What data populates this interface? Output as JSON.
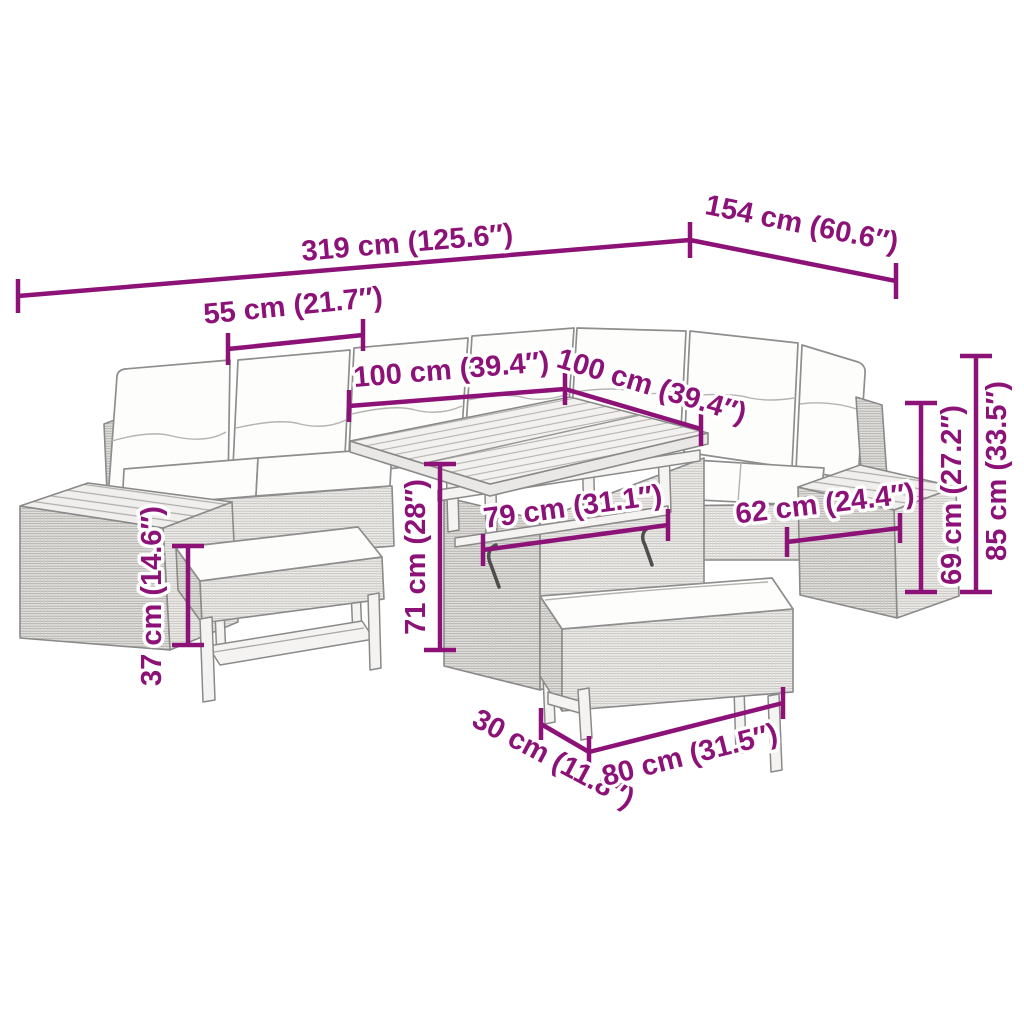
{
  "dimensions": {
    "total_length": "319 cm (125.6″)",
    "total_depth": "154 cm (60.6″)",
    "seat_width": "55 cm (21.7″)",
    "table_top_length": "100 cm (39.4″)",
    "table_top_depth": "100 cm (39.4″)",
    "table_base_width": "79 cm (31.1″)",
    "side_module_width": "62 cm (24.4″)",
    "table_height": "71 cm (28″)",
    "bench_height": "37 cm (14.6″)",
    "backrest_height": "69 cm (27.2″)",
    "total_height": "85 cm (33.5″)",
    "bench_depth": "30 cm (11.8″)",
    "bench_length": "80 cm (31.5″)"
  },
  "colors": {
    "annotation_purple": "#8C1278"
  }
}
